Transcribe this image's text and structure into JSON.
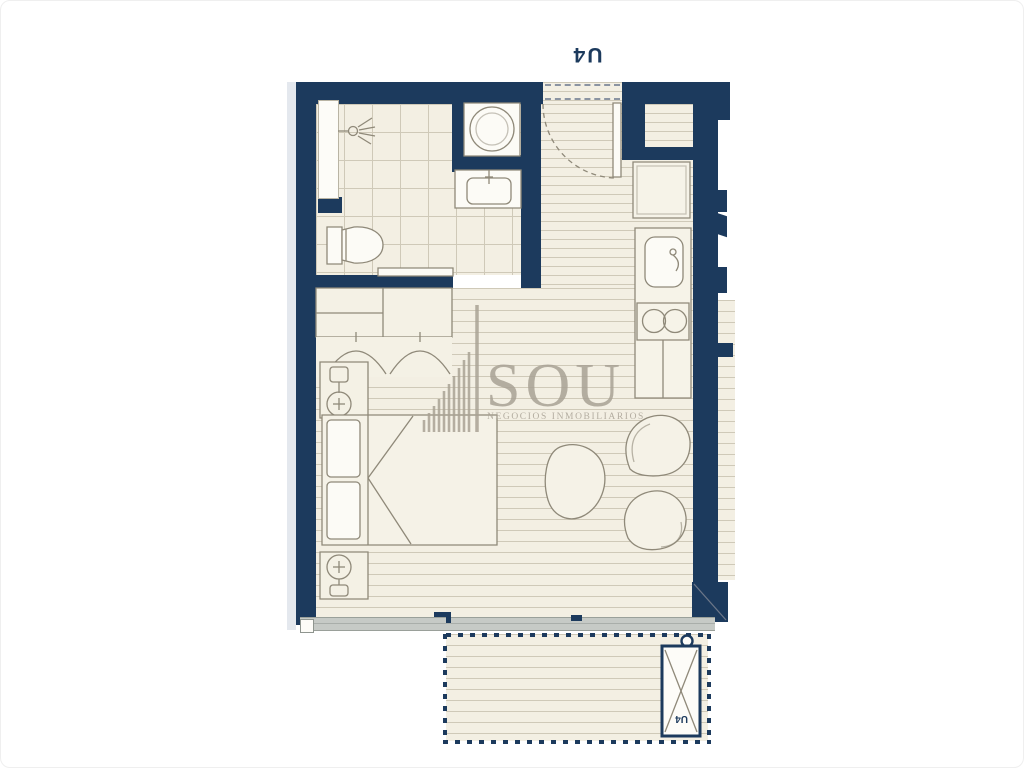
{
  "plan": {
    "unit_label": "U4",
    "ac_unit_label": "U4",
    "watermark": {
      "name": "SOU",
      "tagline": "NEGOCIOS INMOBILIARIOS"
    },
    "colors": {
      "wall": "#1c3a5d",
      "floor": "#f3efe3",
      "hatch_line": "#cfc9b8",
      "outline": "#8f8979",
      "watermark": "#a9a295",
      "track": "#c6cac6"
    },
    "rooms": [
      "bathroom",
      "entry",
      "kitchen",
      "living-bedroom",
      "balcony"
    ],
    "fixtures": [
      "shower",
      "washing-machine",
      "bathroom-sink",
      "toilet",
      "sliding-bath-door",
      "entry-door",
      "closet-niche",
      "fridge",
      "kitchen-sink",
      "cooktop",
      "wardrobe",
      "hanging-clothes",
      "nightstand-lamp",
      "double-bed",
      "nightstand-lamp",
      "side-table",
      "lounge-chair",
      "lounge-chair",
      "sliding-glass-door",
      "balcony-railing",
      "ac-unit"
    ]
  }
}
